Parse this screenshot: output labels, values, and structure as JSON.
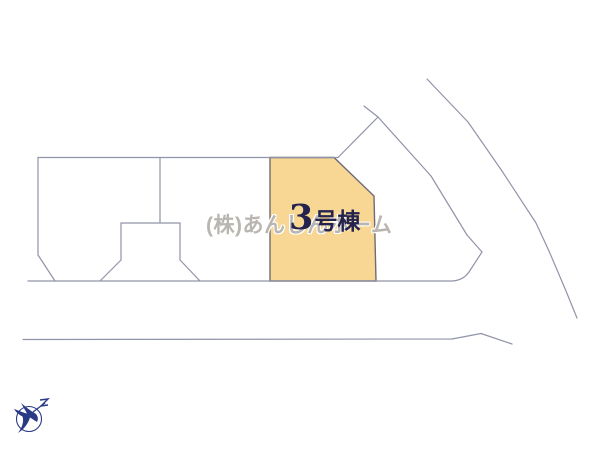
{
  "diagram": {
    "type": "real-estate-site-plan",
    "highlight_lot": {
      "label": "3号棟",
      "label_number": "3",
      "label_suffix": "号棟",
      "fill_color": "#F8D794",
      "border_color": "#6F6B76",
      "label_color": "#23234D"
    },
    "watermark": {
      "text": "(株)あんしんホーム",
      "color": "#B9B6B1"
    },
    "colors": {
      "background": "#FFFFFF",
      "lot_line": "#9094A8"
    },
    "compass": {
      "icon": "north-compass-bird",
      "color": "#2A3A85"
    }
  }
}
